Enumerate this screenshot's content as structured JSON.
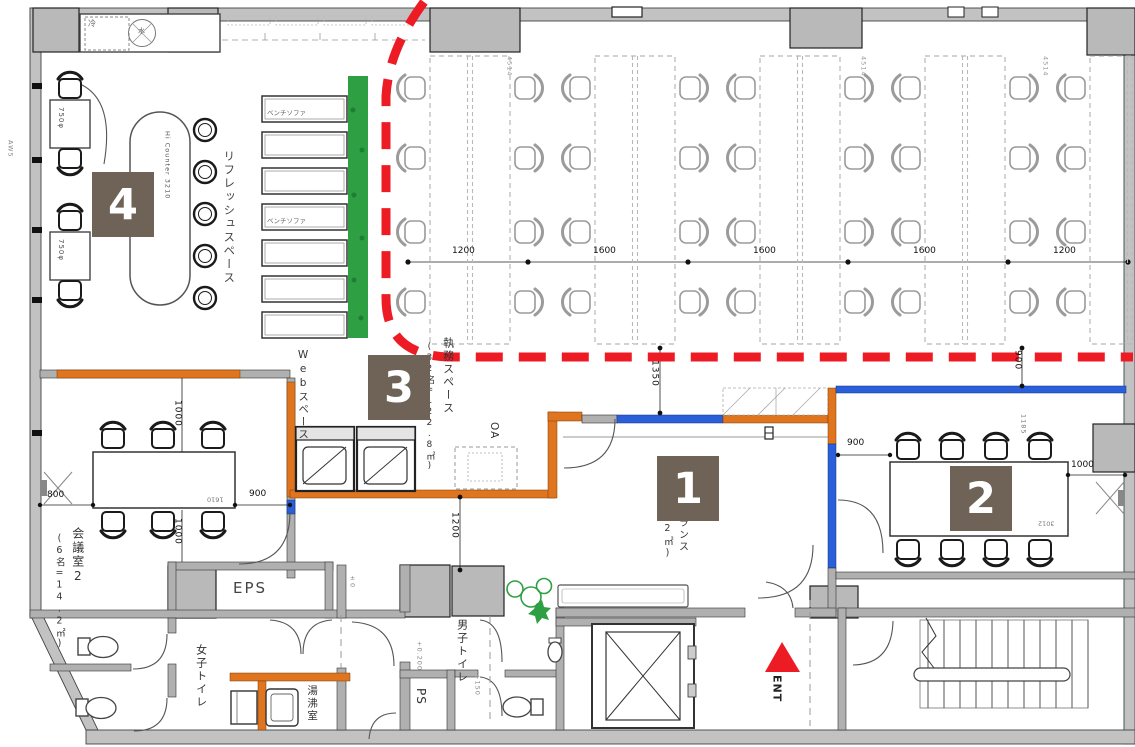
{
  "colors": {
    "marker_bg": "#6E6356",
    "marker_text": "#FFFFFF",
    "zone_line_red": "#ED1C24",
    "entrance_arrow_red": "#ED1C24",
    "wall_orange": "#E07520",
    "wall_blue": "#2B5FD9",
    "greenery_green": "#2EA043",
    "wall_gray": "#C2C2C2"
  },
  "markers": {
    "m1": "1",
    "m2": "2",
    "m3": "3",
    "m4": "4"
  },
  "rooms": {
    "refresh_space": "リフレッシュスペース",
    "web_space": "Webスペース",
    "work_space": "執務スペース",
    "work_space_capacity": "(32名=122.8㎡)",
    "meeting_room_2": "会議室2",
    "meeting_room_2_capacity": "(6名=14.2㎡)",
    "entrance_fragment_main": "ランス",
    "entrance_fragment_area": "2㎡)",
    "eps": "EPS",
    "womens_toilet": "女子トイレ",
    "mens_toilet": "男子トイレ",
    "pipe_space": "PS",
    "hot_water_room": "湯沸室",
    "oa": "OA",
    "entrance_marker": "ENT",
    "fridge": "冷",
    "water": "水"
  },
  "furniture": {
    "hi_counter": "Hi Counter 3210",
    "bench_sofa_a": "ベンチソファ",
    "bench_sofa_b": "ベンチソファ",
    "round_table_a": "750φ",
    "round_table_b": "750φ"
  },
  "dimensions": {
    "desk_pitch": [
      "1200",
      "1600",
      "1600",
      "1600",
      "1200"
    ],
    "entrance_depth": "1350",
    "office_right": "900",
    "corridor_1200": "1200",
    "m2_top": "1000",
    "m2_bottom": "1000",
    "m2_left": "800",
    "m2_right": "900",
    "m2_table": "1610",
    "mr2_left": "900",
    "mr2_right": "1000",
    "mr2_top": "1185",
    "mr2_table": "3012",
    "desk_width": "4514",
    "wall_note": "AW5"
  },
  "levels": {
    "a": "±0",
    "b": "+0.200",
    "c": "+150"
  },
  "plan": {
    "office": {
      "islands_x": [
        430,
        595,
        760,
        925,
        1090
      ],
      "island_w": 80,
      "top": 56,
      "height": 288,
      "rows_y": [
        88,
        158,
        232,
        302
      ],
      "chair_gap": 17
    },
    "benches": {
      "x": 262,
      "w": 85,
      "h": 26,
      "rows_y": [
        96,
        132,
        168,
        204,
        240,
        276,
        312
      ]
    },
    "stools": {
      "x": 205,
      "rows_y": [
        130,
        172,
        214,
        256,
        298
      ],
      "r": 11
    },
    "meeting2_chairs": {
      "top_y": 437,
      "bottom_y": 523,
      "cols_x": [
        113,
        163,
        213
      ]
    },
    "meeting_room2_chairs": {
      "top_y": 448,
      "bottom_y": 551,
      "cols_x": [
        908,
        952,
        996,
        1040
      ]
    },
    "refresh_chairs": [
      {
        "x": 70,
        "y": 87,
        "r": 90
      },
      {
        "x": 70,
        "y": 160,
        "r": -90
      },
      {
        "x": 70,
        "y": 219,
        "r": 90
      },
      {
        "x": 70,
        "y": 292,
        "r": -90
      }
    ]
  }
}
